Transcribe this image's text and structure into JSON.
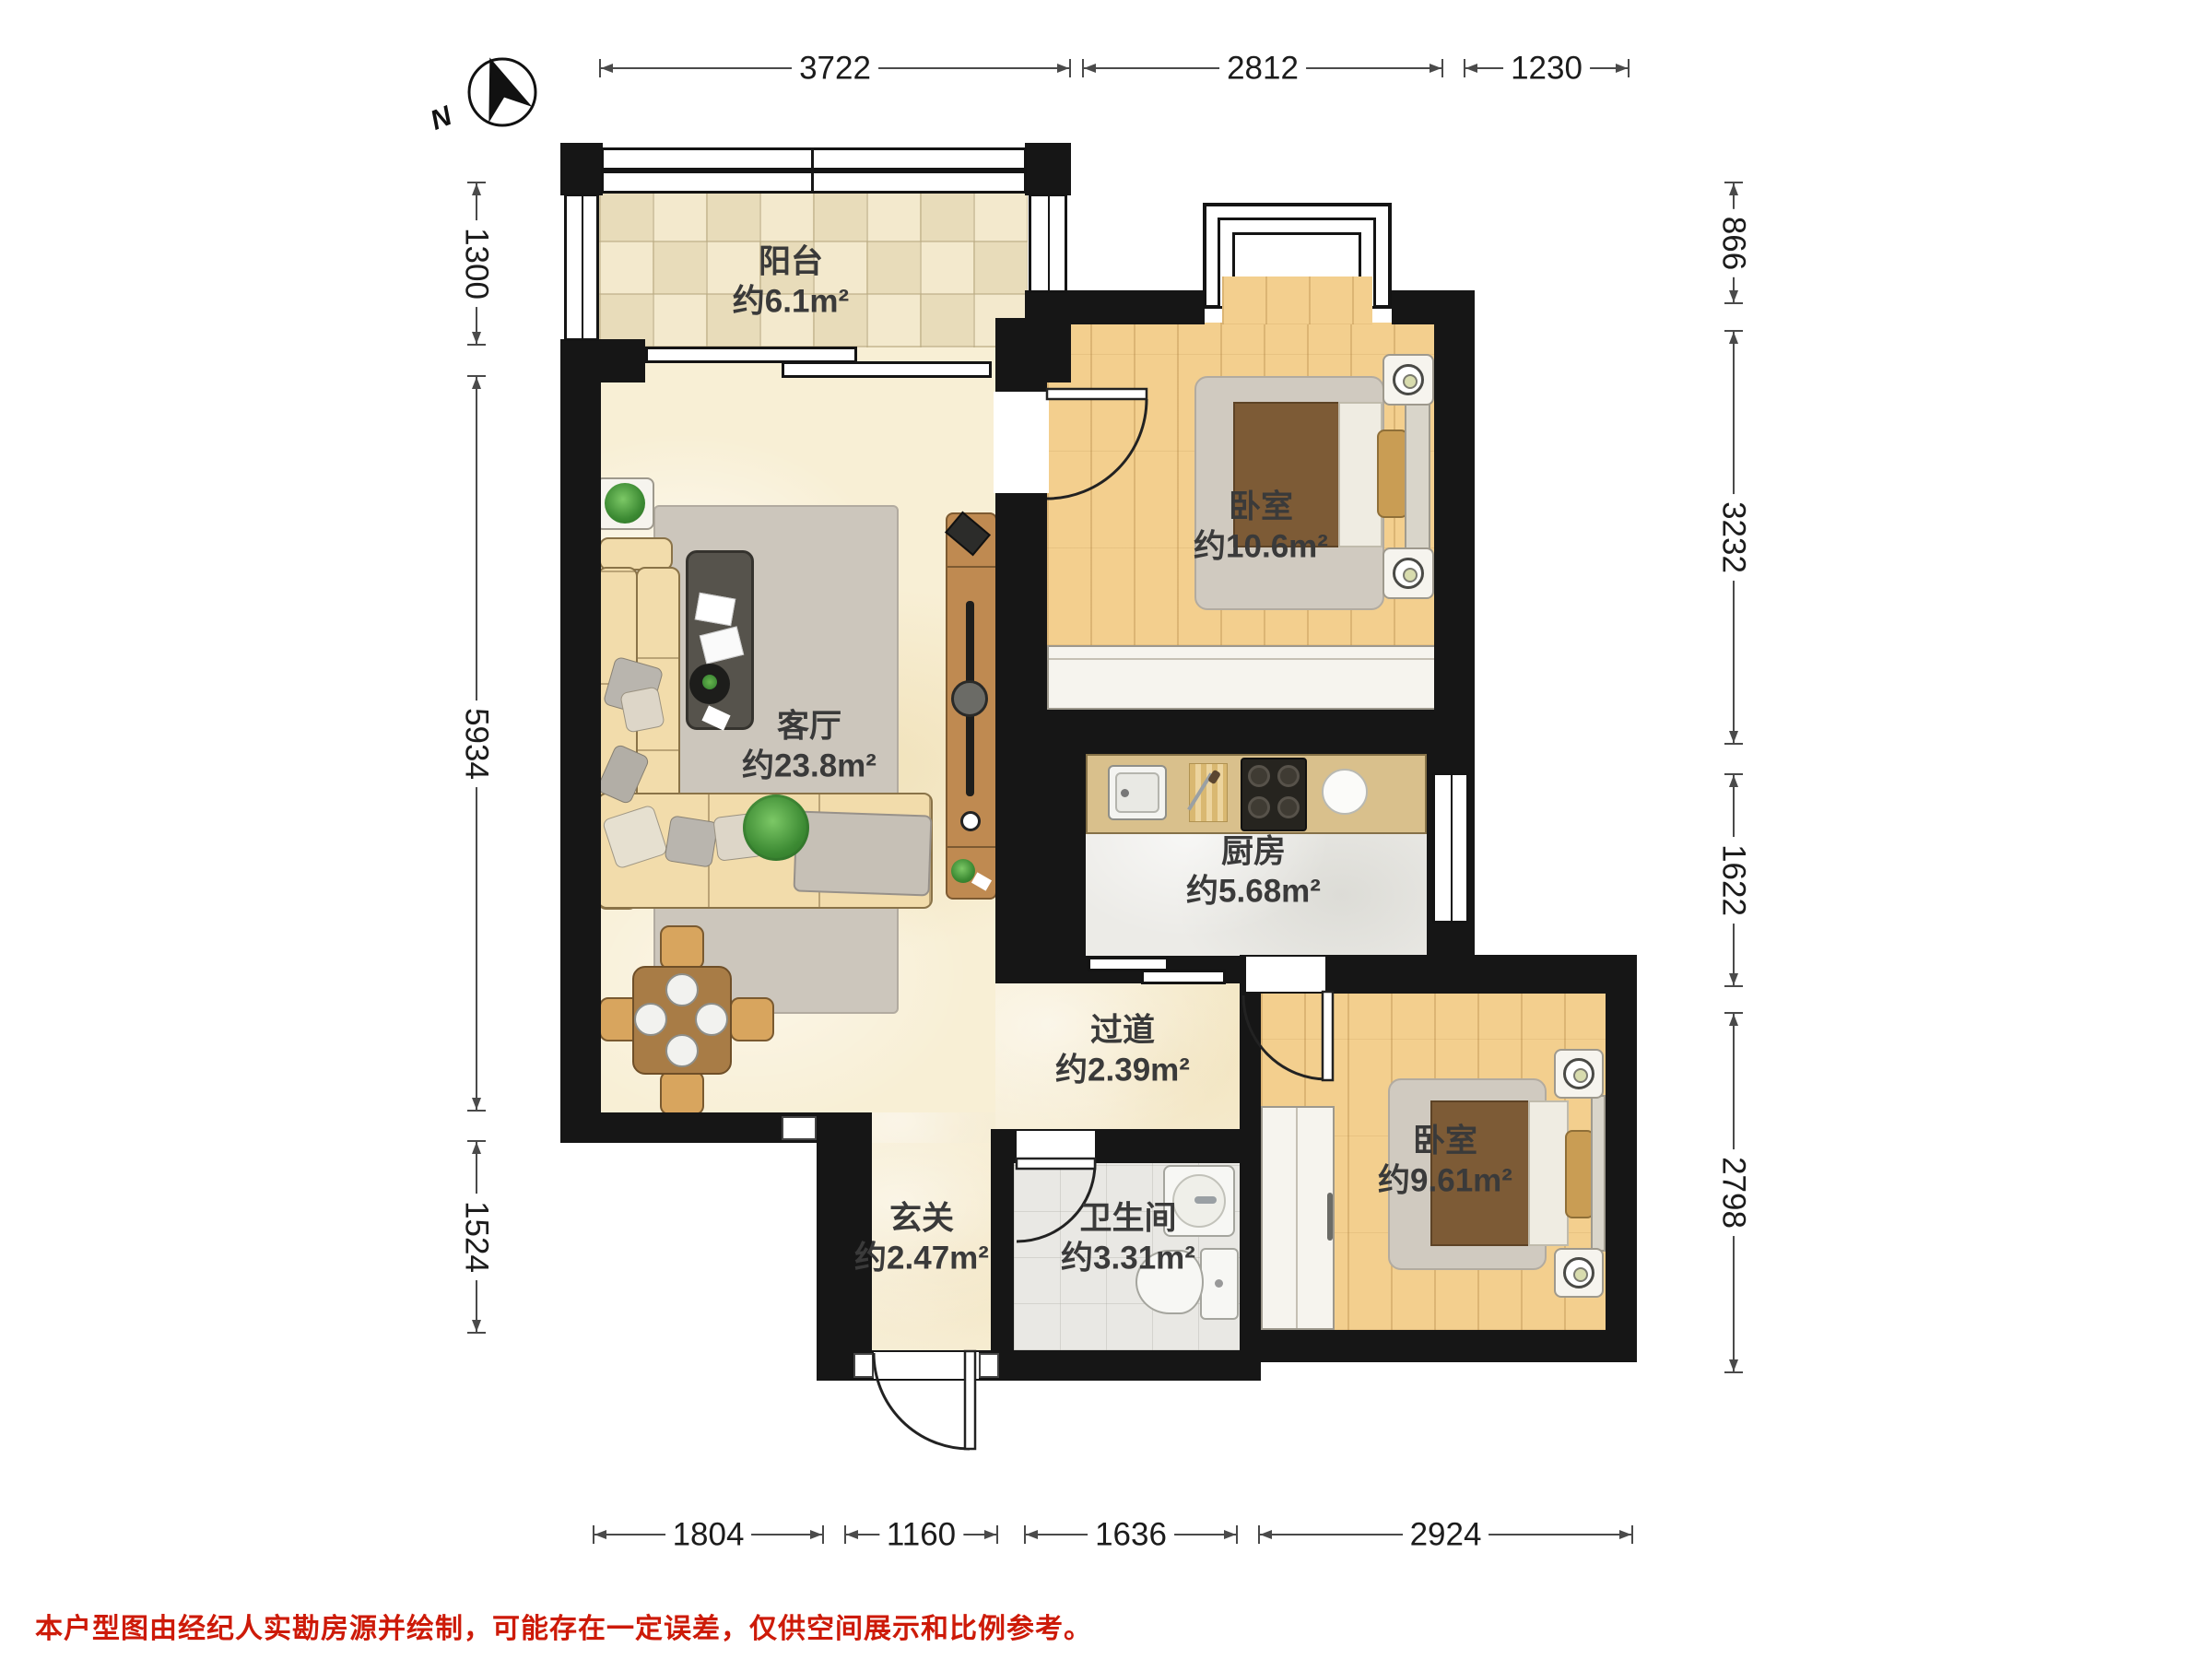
{
  "compass": {
    "north_label": "N"
  },
  "disclaimer": "本户型图由经纪人实勘房源并绘制，可能存在一定误差，仅供空间展示和比例参考。",
  "rooms": {
    "balcony": {
      "name": "阳台",
      "area": "约6.1m²"
    },
    "bedroom_top": {
      "name": "卧室",
      "area": "约10.6m²"
    },
    "living_room": {
      "name": "客厅",
      "area": "约23.8m²"
    },
    "kitchen": {
      "name": "厨房",
      "area": "约5.68m²"
    },
    "hallway": {
      "name": "过道",
      "area": "约2.39m²"
    },
    "bedroom_bottom": {
      "name": "卧室",
      "area": "约9.61m²"
    },
    "entry": {
      "name": "玄关",
      "area": "约2.47m²"
    },
    "bathroom": {
      "name": "卫生间",
      "area": "约3.31m²"
    }
  },
  "dimensions_mm": {
    "top": [
      "3722",
      "2812",
      "1230"
    ],
    "left": [
      "1300",
      "5934",
      "1524"
    ],
    "right": [
      "866",
      "3232",
      "1622",
      "2798"
    ],
    "bottom": [
      "1804",
      "1160",
      "1636",
      "2924"
    ]
  },
  "colors": {
    "wall": "#161616",
    "disclaimer_red": "#cd1a08",
    "wood_floor": "#f3cf8e",
    "cream_floor": "#f8efd5",
    "tile_a": "#f3e9cd",
    "tile_b": "#e8dcba"
  }
}
